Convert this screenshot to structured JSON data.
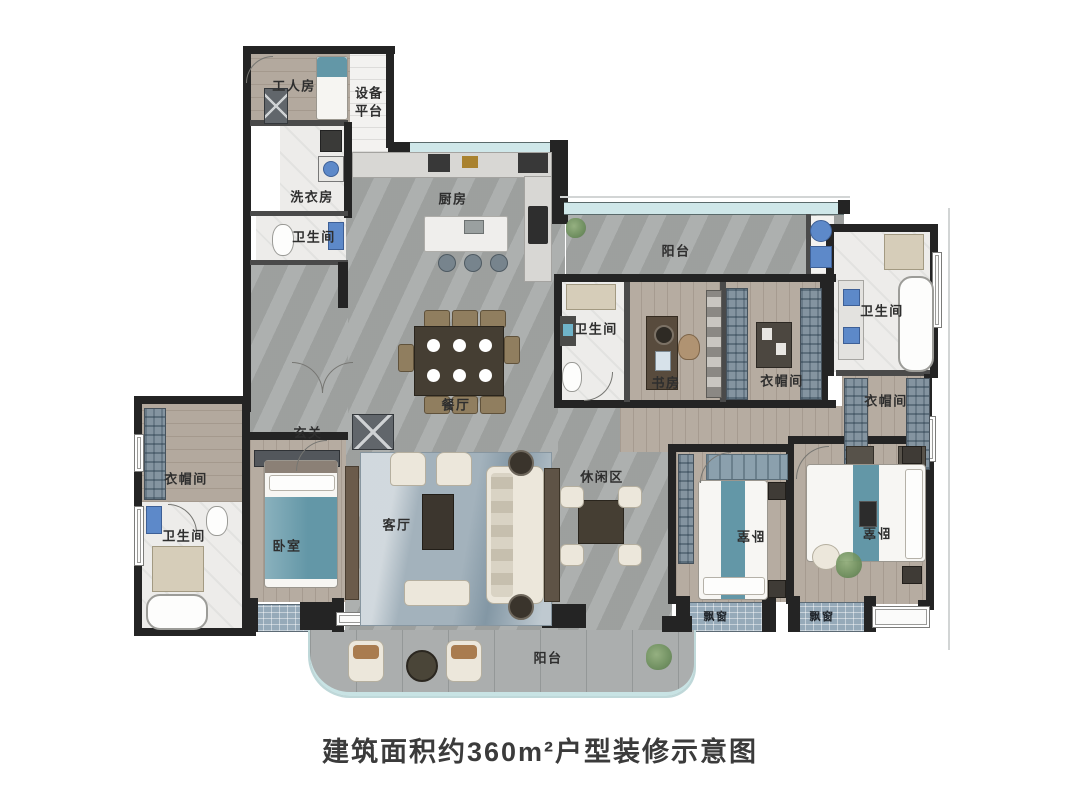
{
  "caption": "建筑面积约360m²户型装修示意图",
  "rooms": {
    "worker_room": "工人房",
    "equipment_platform": "设备平台",
    "laundry": "洗衣房",
    "bath_top_left": "卫生间",
    "kitchen": "厨房",
    "balcony_top": "阳台",
    "bath_mid": "卫生间",
    "study": "书房",
    "closet_mid": "衣帽间",
    "bath_right": "卫生间",
    "closet_right": "衣帽间",
    "dining": "餐厅",
    "foyer": "玄关",
    "closet_left": "衣帽间",
    "bath_left": "卫生间",
    "bedroom_left": "卧室",
    "living": "客厅",
    "leisure": "休闲区",
    "bedroom_mid": "卧室",
    "bedroom_right": "卧室",
    "bay_window_mid": "飘窗",
    "bay_window_right": "飘窗",
    "balcony_bottom": "阳台"
  },
  "colors": {
    "wall": "#242424",
    "marble_floor": "#a5a8a7",
    "wood_floor": "#b6aca1",
    "tile_floor": "#edecea",
    "accent_teal": "#6397a7",
    "window_glass": "#cfe7e9",
    "wardrobe_blue": "#8494a0",
    "rug_blue": "#a3b2bc",
    "furniture_dark": "#453e33",
    "furniture_cream": "#ece7db"
  }
}
